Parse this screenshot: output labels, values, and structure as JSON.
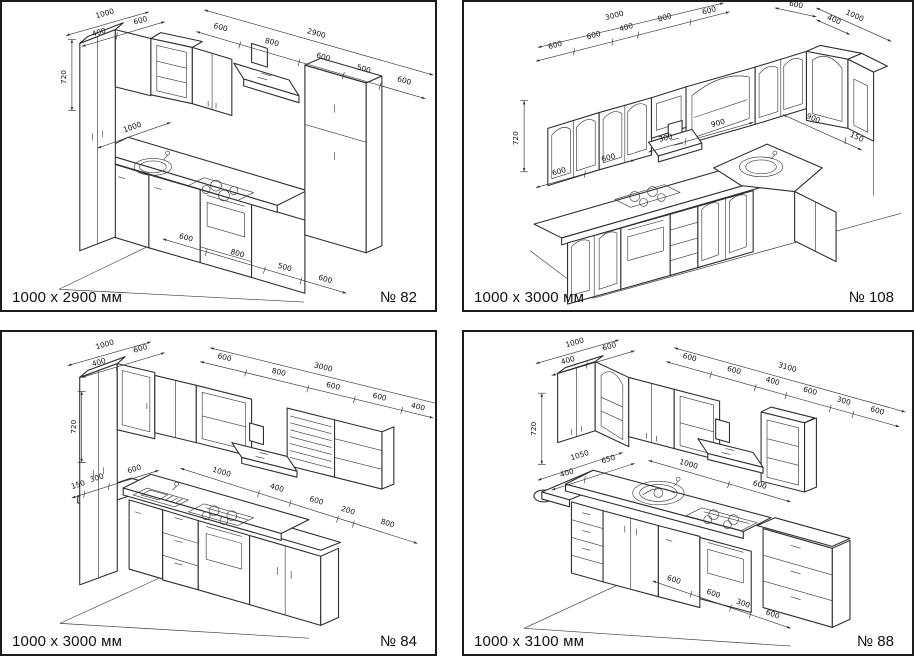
{
  "colors": {
    "line": "#2e2e2e",
    "background": "#ffffff",
    "border": "#1c1c1c"
  },
  "panels": [
    {
      "size": "1000 x 2900 мм",
      "number": "№ 82",
      "dims": {
        "left": [
          "1000",
          "400",
          "600"
        ],
        "height": "720",
        "counter": [
          "1000"
        ],
        "top_overall": "2900",
        "top": [
          "600",
          "800",
          "600",
          "500",
          "600"
        ],
        "floor": [
          "600",
          "800",
          "500",
          "600"
        ]
      }
    },
    {
      "size": "1000 x 3000 мм",
      "number": "№ 108",
      "dims": {
        "top": [
          "600",
          "600",
          "400",
          "800",
          "600"
        ],
        "top_overall": "3000",
        "right": [
          "600",
          "1000",
          "400"
        ],
        "height": "720",
        "mid": [
          "600",
          "600",
          "300",
          "900",
          "900",
          "150"
        ]
      }
    },
    {
      "size": "1000 x 3000 мм",
      "number": "№ 84",
      "dims": {
        "left": [
          "1000",
          "400",
          "600"
        ],
        "height": "720",
        "top_overall": "3000",
        "top": [
          "600",
          "800",
          "600",
          "600",
          "400"
        ],
        "counter_left": [
          "150",
          "300",
          "600"
        ],
        "counter": [
          "1000",
          "400",
          "600",
          "200",
          "800"
        ]
      }
    },
    {
      "size": "1000 x 3100 мм",
      "number": "№ 88",
      "dims": {
        "left": [
          "1000",
          "400",
          "600"
        ],
        "height": "720",
        "top_overall": "3100",
        "top": [
          "600",
          "600",
          "400",
          "600",
          "300",
          "600"
        ],
        "counter_left": [
          "1050",
          "400",
          "650"
        ],
        "counter": [
          "1000",
          "600"
        ],
        "floor": [
          "600",
          "600",
          "300",
          "600"
        ]
      }
    }
  ]
}
